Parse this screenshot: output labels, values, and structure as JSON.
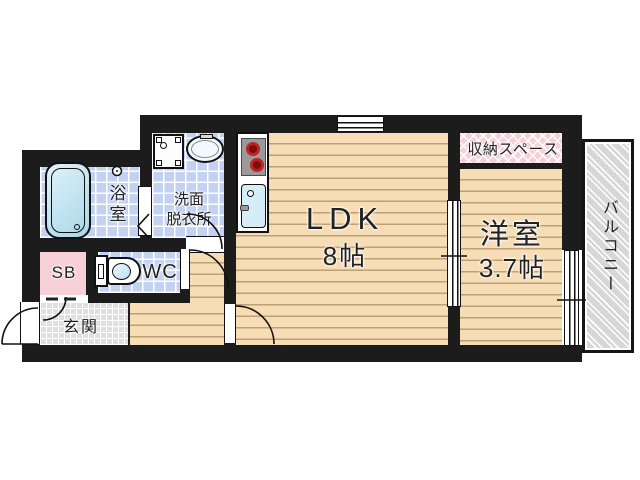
{
  "plan": {
    "type": "apartment-floor-plan",
    "rooms": {
      "ldk": {
        "name": "LDK",
        "size": "8帖"
      },
      "western_room": {
        "name": "洋室",
        "size": "3.7帖"
      },
      "storage": {
        "label": "収納スペース"
      },
      "balcony": {
        "label": "バルコニー"
      },
      "bathroom": {
        "label": "浴室"
      },
      "washroom": {
        "line1": "洗面",
        "line2": "脱衣所"
      },
      "toilet": {
        "label": "WC"
      },
      "shoe_box": {
        "label": "SB"
      },
      "entrance": {
        "label": "玄関"
      }
    },
    "colors": {
      "wall": "#1c1c1c",
      "wood_floor": "#f6ddb5",
      "wet_area_tile": "#c3d2f0",
      "entrance_tile": "#e0e0e0",
      "storage_pink": "#f7cfd6",
      "balcony_gray": "#d7d7d7",
      "burner_red": "#c22222",
      "text": "#222222"
    }
  }
}
